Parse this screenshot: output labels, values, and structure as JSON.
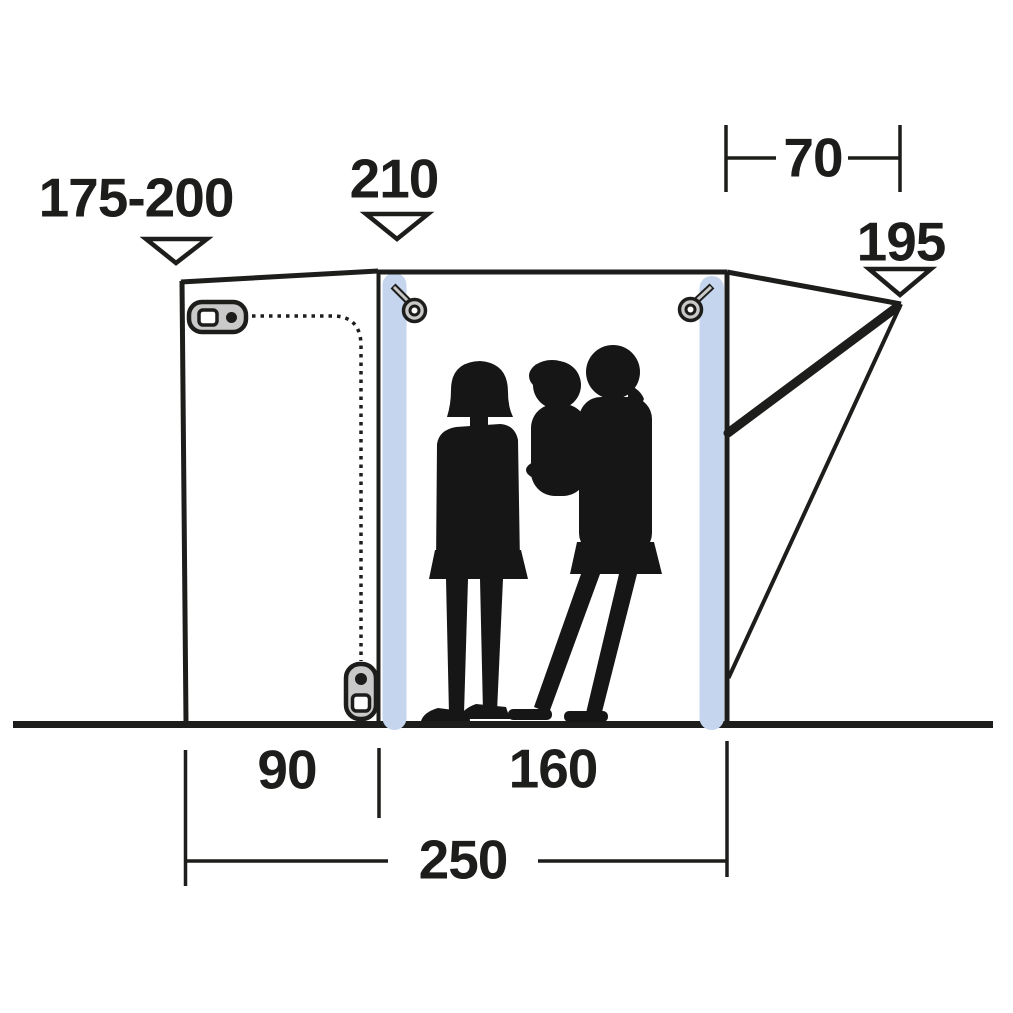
{
  "diagram": {
    "description": "Side-profile dimension diagram of a drive-away tent awning with family silhouette",
    "background": "#ffffff",
    "line_color": "#1d1d1b",
    "colors": {
      "air_pole_blue": "#c5d5ee",
      "hardware_gray": "#c9c9c9",
      "silhouette_black": "#161616"
    },
    "dimensions": {
      "attachment_height_range": "175-200",
      "peak_height": "210",
      "tunnel_depth": "70",
      "rear_edge_height": "195",
      "front_section_width": "90",
      "main_section_width": "160",
      "total_width": "250"
    },
    "icons": {
      "toggle_clip": "zipper-toggle-clip",
      "zipper_pull": "zipper-pull-slider",
      "hang_loops": "hanging-ring-loop",
      "arrows": "down-pointer-triangle"
    }
  }
}
